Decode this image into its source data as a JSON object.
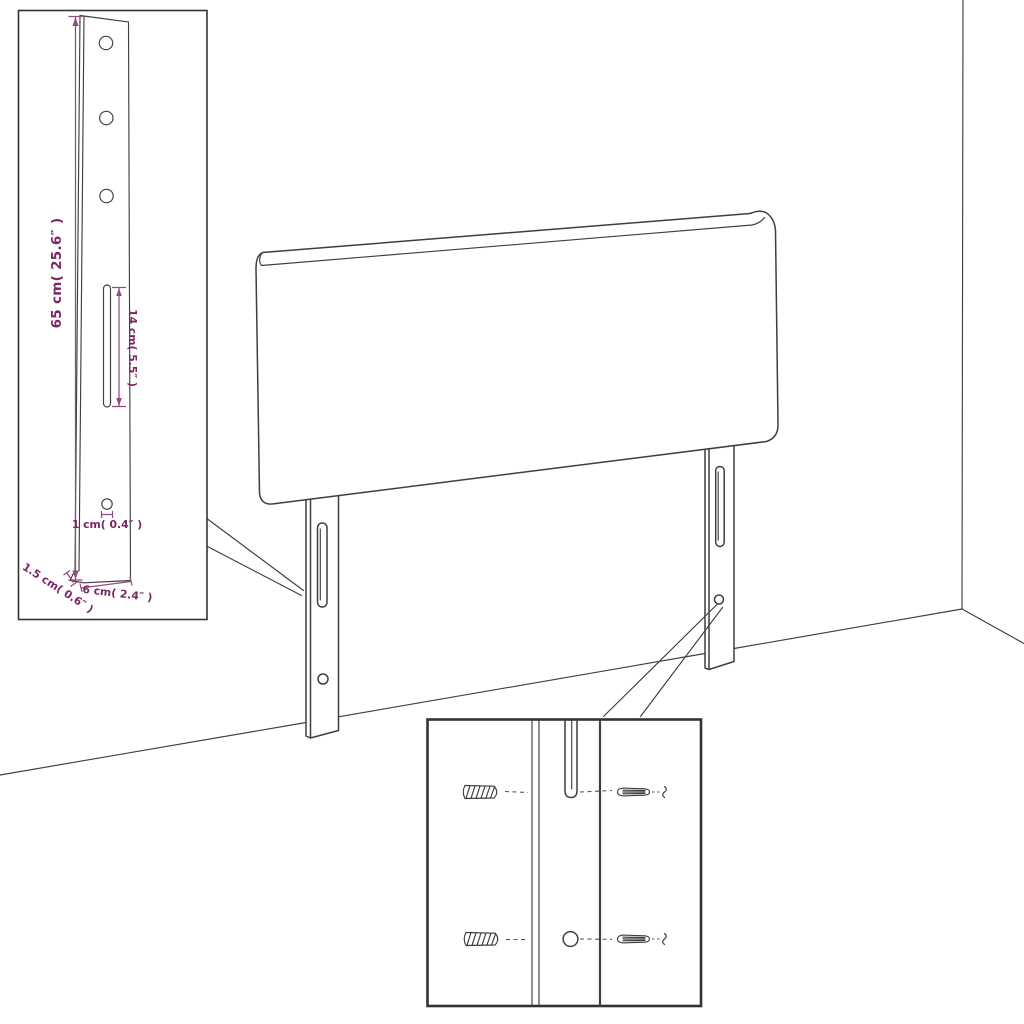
{
  "colors": {
    "background": "#ffffff",
    "drawing_line": "#3f3f3f",
    "inset_border": "#333333",
    "dimension_line": "#95497f",
    "dimension_text": "#7a2763"
  },
  "leg_detail_inset": {
    "dimensions": {
      "leg_height": "65 cm( 25.6″ )",
      "slot_length": "14 cm( 5.5″ )",
      "hole_diameter": "1 cm( 0.4″ )",
      "leg_depth": "1.5 cm( 0.6″ )",
      "leg_width": "6 cm( 2.4″ )"
    },
    "hole_count_upper": 3,
    "slot_count": 1,
    "hole_count_lower": 1
  },
  "hardware_detail_inset": {
    "wall_plug_count": 2,
    "screw_count": 2,
    "icons": [
      "wall-plug-icon",
      "screw-icon",
      "mounting-slot",
      "mounting-hole"
    ]
  },
  "main_drawing": {
    "legs": 2,
    "slots_per_leg": 1,
    "holes_per_leg": 1
  }
}
